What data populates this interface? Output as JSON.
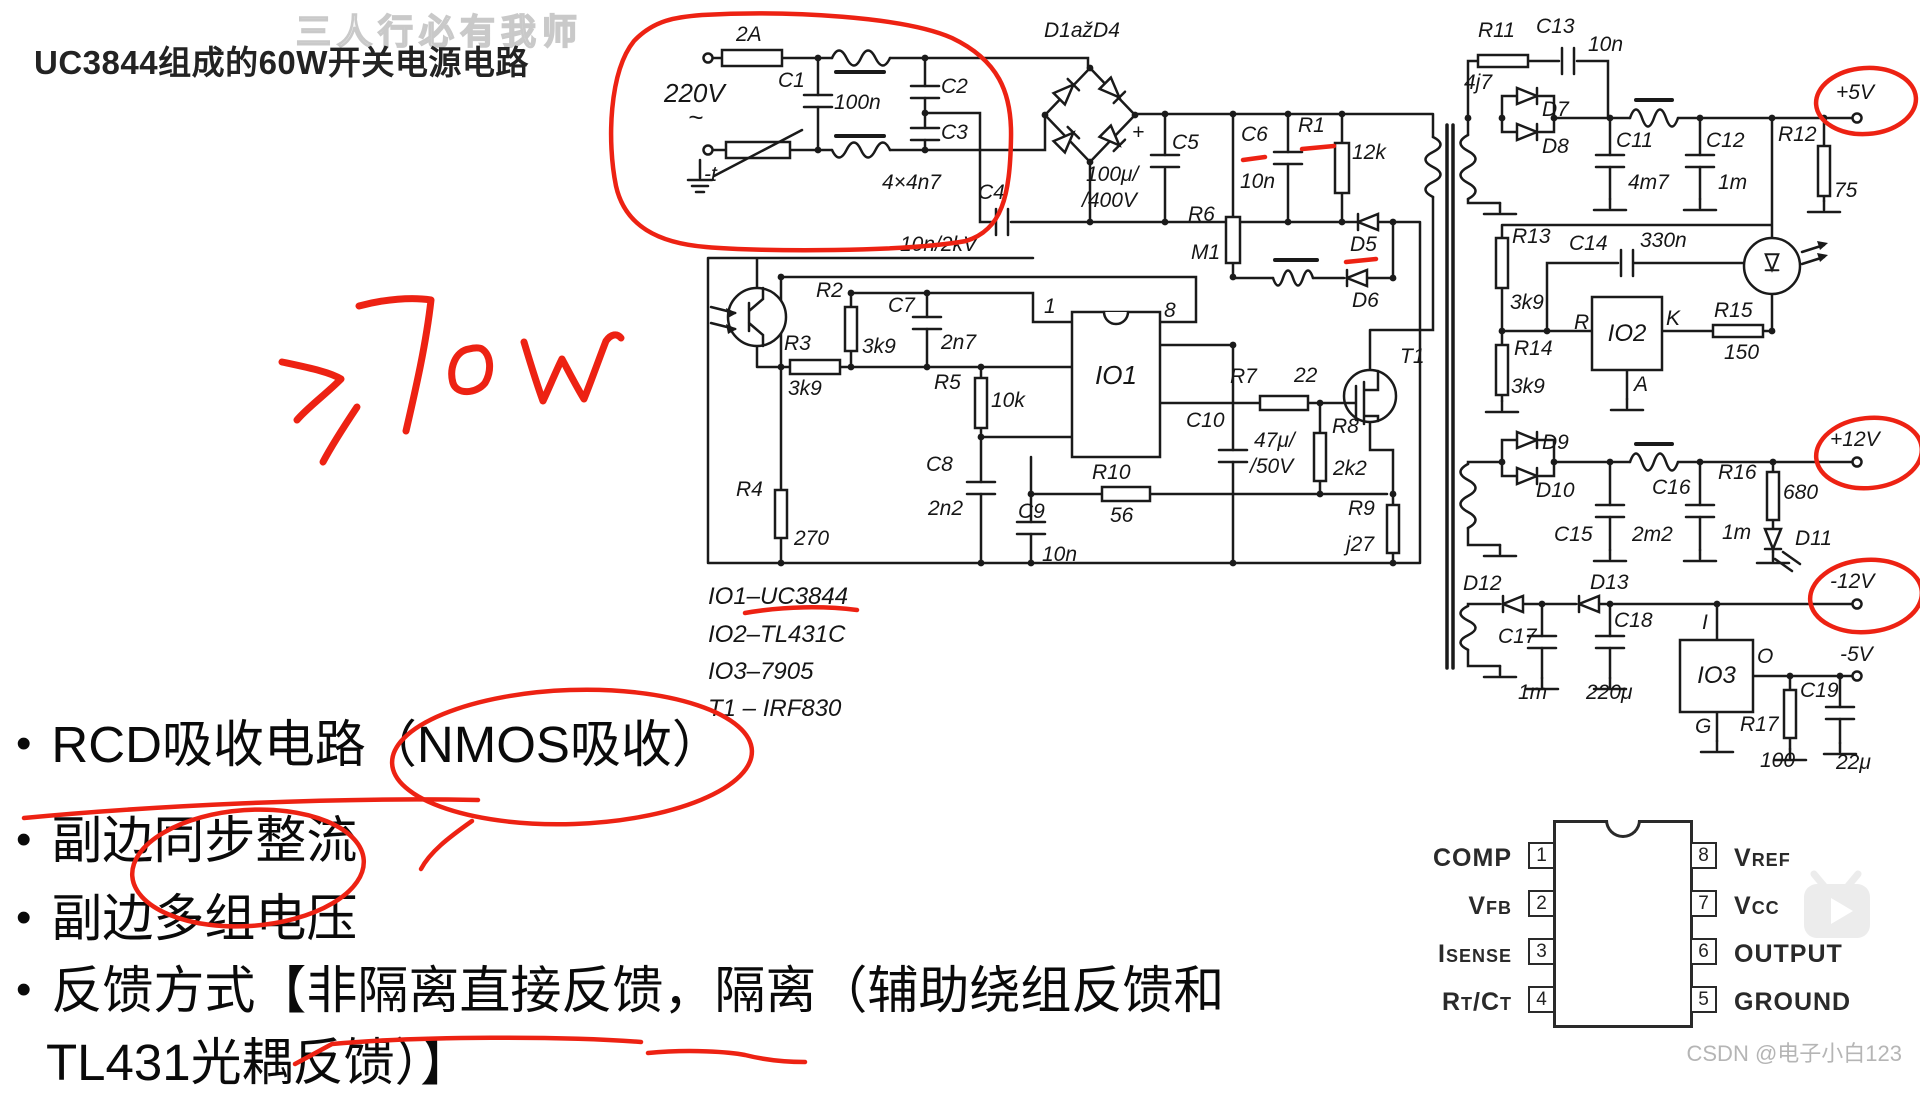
{
  "header": {
    "watermark": "三人行必有我师",
    "title": "UC3844组成的60W开关电源电路"
  },
  "footer": {
    "watermark": "CSDN @电子小白123"
  },
  "annotations": {
    "handwritten_power_note": "≥70W"
  },
  "sch": {
    "fuse": "2A",
    "vin": "220V",
    "vac": "~",
    "ntc": "-t",
    "c1": "C1",
    "c1v": "100n",
    "c2": "C2",
    "c3": "C3",
    "cxv": "4×4n7",
    "c4": "C4",
    "c4v": "10n/2kV",
    "d14": "D1ažD4",
    "plus": "+",
    "c5": "C5",
    "c5v": "100μ/",
    "c5v2": "/400V",
    "r6": "R6",
    "r6v": "M1",
    "c6": "C6",
    "c6v": "10n",
    "r1": "R1",
    "r1v": "12k",
    "d5": "D5",
    "d6": "D6",
    "p1": "1",
    "p8": "8",
    "io1": "IO1",
    "r2": "R2",
    "r2v": "3k9",
    "c7": "C7",
    "c7v": "2n7",
    "r3": "R3",
    "r3v": "3k9",
    "r5": "R5",
    "r5v": "10k",
    "c8": "C8",
    "c8v": "2n2",
    "c9": "C9",
    "c9v": "10n",
    "r10": "R10",
    "r10v": "56",
    "r4": "R4",
    "r4v": "270",
    "c10": "C10",
    "c10v": "47μ/",
    "c10v2": "/50V",
    "r7": "R7",
    "r7v": "22",
    "r8": "R8",
    "r8v": "2k2",
    "t1": "T1",
    "r9": "R9",
    "r9v": "j27",
    "r11": "R11",
    "r11v": "4j7",
    "c13": "C13",
    "c13v": "10n",
    "d7": "D7",
    "d8": "D8",
    "c11": "C11",
    "c11v": "4m7",
    "c12": "C12",
    "c12v": "1m",
    "r12": "R12",
    "r12v": "75",
    "p5": "+5V",
    "r13": "R13",
    "r13v": "3k9",
    "r14": "R14",
    "r14v": "3k9",
    "c14": "C14",
    "c14v": "330n",
    "io2": "IO2",
    "kr": "R",
    "kk": "K",
    "ka": "A",
    "r15": "R15",
    "r15v": "150",
    "d9": "D9",
    "d10": "D10",
    "c15": "C15",
    "c15v": "2m2",
    "c16": "C16",
    "c16v": "1m",
    "r16": "R16",
    "r16v": "680",
    "d11": "D11",
    "p12": "+12V",
    "d12": "D12",
    "d13": "D13",
    "c17": "C17",
    "c17v": "1m",
    "c18": "C18",
    "c18v": "220μ",
    "io3": "IO3",
    "i3i": "I",
    "i3o": "O",
    "i3g": "G",
    "r17": "R17",
    "r17v": "100",
    "c19": "C19",
    "c19v": "22μ",
    "n12": "-12V",
    "n5": "-5V"
  },
  "legend": {
    "l1": "IO1–UC3844",
    "l2": "IO2–TL431C",
    "l3": "IO3–7905",
    "l4": "T1 – IRF830"
  },
  "bullets": {
    "b1": "RCD吸收电路（NMOS吸收）",
    "b2": "副边同步整流",
    "b3": "副边多组电压",
    "b4a": "反馈方式【非隔离直接反馈，隔离（辅助绕组反馈和",
    "b4b": "TL431光耦反馈）】"
  },
  "pinout": {
    "left": [
      {
        "num": "1",
        "segs": [
          {
            "t": "COMP"
          }
        ]
      },
      {
        "num": "2",
        "segs": [
          {
            "t": "V"
          },
          {
            "t": "FB"
          }
        ]
      },
      {
        "num": "3",
        "segs": [
          {
            "t": "I"
          },
          {
            "t": "SENSE"
          }
        ]
      },
      {
        "num": "4",
        "segs": [
          {
            "t": "R"
          },
          {
            "t": "T"
          },
          {
            "t": "/C"
          },
          {
            "t": "T"
          }
        ]
      }
    ],
    "right": [
      {
        "num": "8",
        "segs": [
          {
            "t": "V"
          },
          {
            "t": "REF"
          }
        ]
      },
      {
        "num": "7",
        "segs": [
          {
            "t": "V"
          },
          {
            "t": "CC"
          }
        ]
      },
      {
        "num": "6",
        "segs": [
          {
            "t": "OUTPUT"
          }
        ]
      },
      {
        "num": "5",
        "segs": [
          {
            "t": "GROUND"
          }
        ]
      }
    ]
  }
}
